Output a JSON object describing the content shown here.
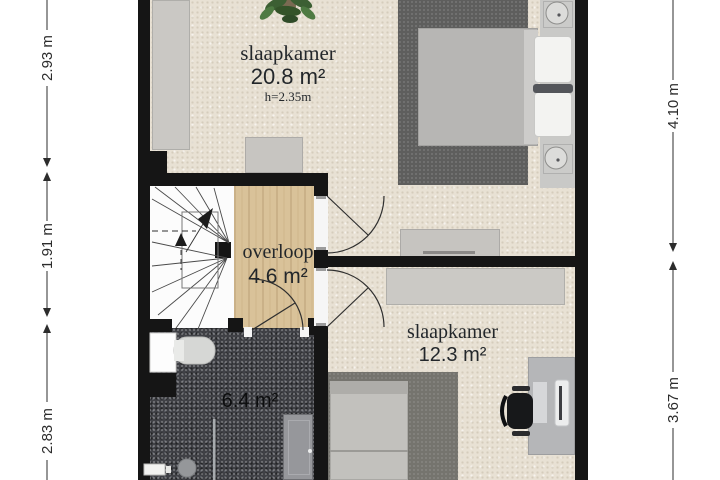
{
  "plan": {
    "type": "floor-plan",
    "floor_label": "verdieping / bedroom floor"
  },
  "rooms": {
    "bedroom_1": {
      "name": "slaapkamer",
      "area": "20.8 m²",
      "ceiling_height": "h=2.35m"
    },
    "landing": {
      "name": "overloop",
      "area": "4.6 m²"
    },
    "bathroom": {
      "area": "6.4 m²"
    },
    "bedroom_2": {
      "name": "slaapkamer",
      "area": "12.3 m²"
    }
  },
  "dimensions": {
    "left": [
      {
        "label": "2.93 m"
      },
      {
        "label": "1.91 m"
      },
      {
        "label": "2.83 m"
      }
    ],
    "right": [
      {
        "label": "4.10 m"
      },
      {
        "label": "3.67 m"
      }
    ]
  },
  "colors": {
    "wall": "#151515",
    "carpet_floor": "#e8e1d4",
    "wood_floor": "#d9c299",
    "bathroom_floor": "#404146",
    "furniture_gray": "#c8c7c5",
    "rug_gray": "#5e5e5d",
    "dimension_text": "#2c2c2c"
  }
}
